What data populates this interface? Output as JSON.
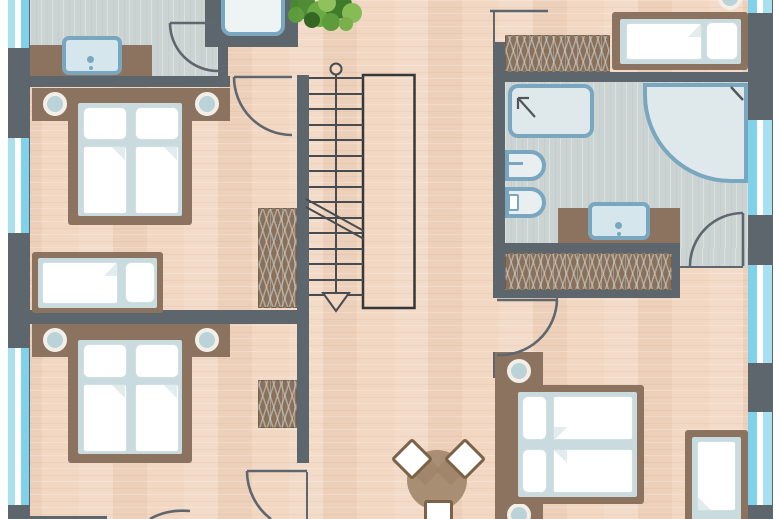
{
  "plan": {
    "kind": "residential-floor-plan",
    "storey_note": "plan cropped top and bottom; staircase with downward arrow in centre",
    "rooms": {
      "bedroom_top_left": {
        "furniture": [
          "double-bed",
          "single-bed",
          "wardrobe"
        ]
      },
      "bathroom_top_left": {
        "furniture": [
          "vanity-sink",
          "bathtub-niche"
        ]
      },
      "bedroom_bottom_left": {
        "furniture": [
          "double-bed",
          "wardrobe"
        ]
      },
      "bedroom_top_right": {
        "furniture": [
          "single-bed",
          "wardrobe"
        ]
      },
      "bathroom_right": {
        "furniture": [
          "shower",
          "corner-bathtub",
          "toilet",
          "bidet",
          "vanity-sink",
          "wardrobe"
        ]
      },
      "bedroom_bottom_right": {
        "furniture": [
          "double-bed",
          "single-bed"
        ]
      },
      "hall": {
        "furniture": [
          "staircase",
          "stairwell-void",
          "plant",
          "round-table",
          "chairs"
        ]
      }
    },
    "counts": {
      "double_beds": 3,
      "single_beds": 3,
      "wardrobes": 4,
      "doors": 6,
      "windows_left": 3,
      "windows_right": 4,
      "chairs": 3
    }
  },
  "palette": {
    "wall": "#5c666c",
    "wood": "#f2d7c3",
    "tile": "#cbd4d2",
    "brown": "#8c7360",
    "hatchBg": "#8a7058",
    "hatchLine": "rgba(203,211,213,0.55)",
    "mattress": "#c9dbde",
    "beddingEdge": "#cfdfe2",
    "foldShade": "#e2ebed",
    "lampCore": "#b9d3d9",
    "fixture": "#78a7bf",
    "fixtureFill": "#dfe9ec",
    "sinkFill": "#d5e6ec",
    "winA": "#a9e0f0",
    "winB": "#7fd2ea",
    "line": "#545d62",
    "thinLine": "#3a4044",
    "table": "#a88e73",
    "chairBorder": "#7c6348",
    "chairShadow": "#9a7f64",
    "plant1": "#4c8a31",
    "plant2": "#67a83e",
    "plant3": "#3a7827",
    "plant4": "#83bb52",
    "plant5": "#2e641e"
  }
}
